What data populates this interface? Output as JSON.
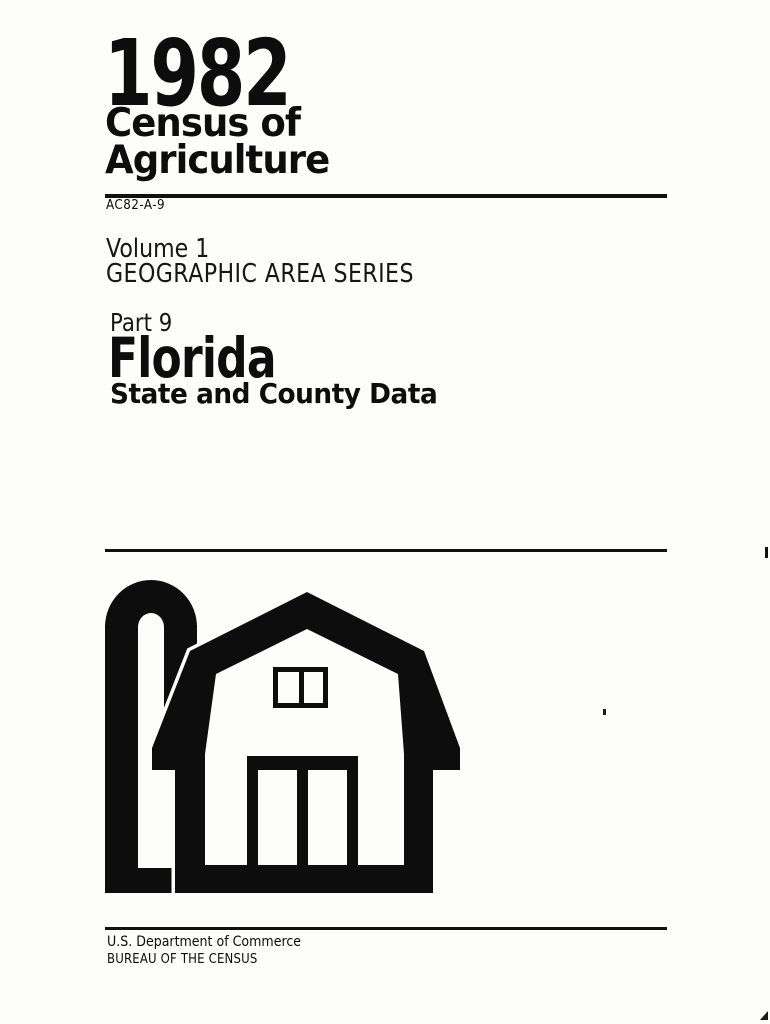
{
  "page": {
    "background": "#fdfdfc",
    "ink": "#0d0d0d"
  },
  "masthead": {
    "year": "1982",
    "title_line1": "Census of",
    "title_line2": "Agriculture",
    "report_code": "AC82-A-9"
  },
  "series": {
    "volume": "Volume 1",
    "series_name": "GEOGRAPHIC AREA SERIES"
  },
  "part": {
    "part_label": "Part 9",
    "state_name": "Florida",
    "subtitle": "State and County Data"
  },
  "logo": {
    "icon": "barn-and-silo-icon"
  },
  "footer": {
    "department": "U.S. Department of Commerce",
    "bureau": "BUREAU OF THE CENSUS"
  }
}
